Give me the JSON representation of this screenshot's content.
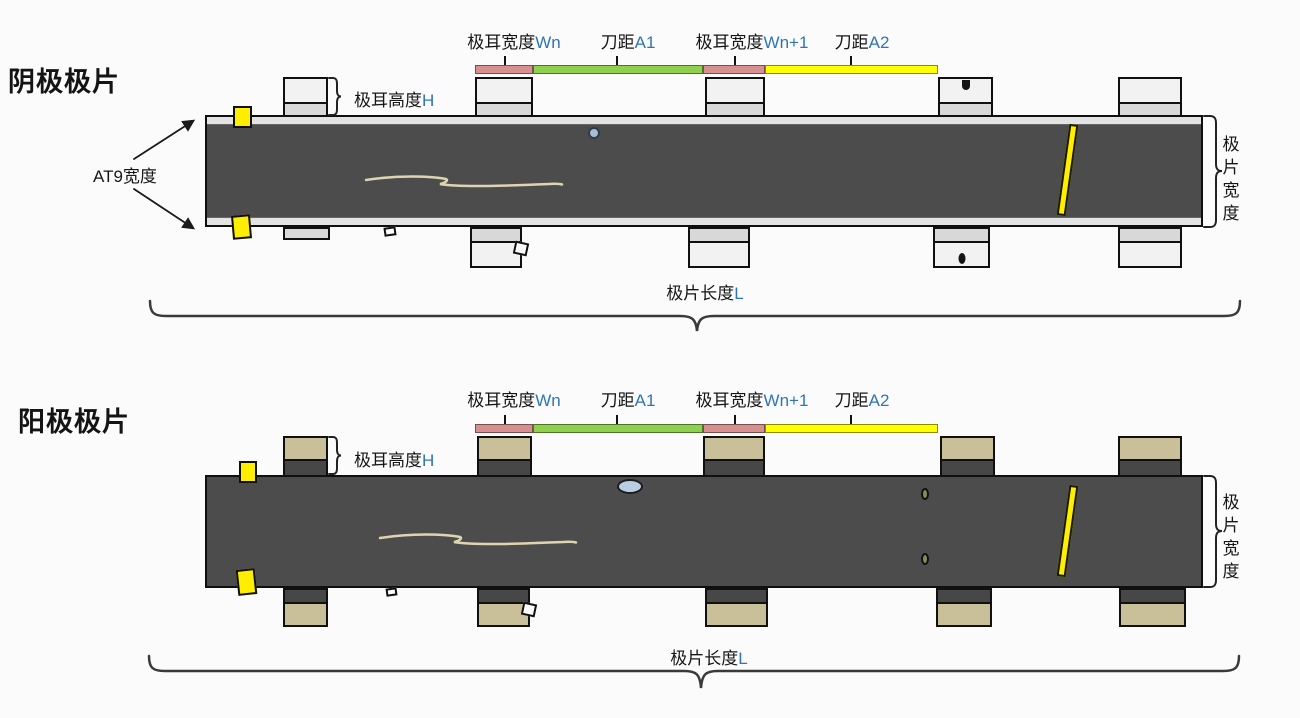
{
  "title_cathode": "阴极极片",
  "title_anode": "阳极极片",
  "dimension_labels": [
    {
      "base": "极耳宽度",
      "accent": "Wn"
    },
    {
      "base": "刀距",
      "accent": "A1"
    },
    {
      "base": "极耳宽度",
      "accent": "Wn+1"
    },
    {
      "base": "刀距",
      "accent": "A2"
    }
  ],
  "tab_height_label": {
    "base": "极耳高度",
    "accent": "H"
  },
  "at9_label": "AT9宽度",
  "sheet_width_label": "极片宽度",
  "sheet_length_label": {
    "base": "极片长度",
    "accent": "L"
  },
  "colors": {
    "accent_text": "#2e75b6",
    "strip_dark": "#4c4c4c",
    "strip_edge_light": "#e3e3e3",
    "cathode_tab_body": "#f2f2f2",
    "cathode_tab_joint": "#d8d8d8",
    "anode_tab_body": "#c9bf99",
    "anode_tab_joint": "#474747",
    "bar_tab_width_pink": "#d79090",
    "bar_knife_a1_green": "#8fd04e",
    "bar_knife_a2_yellow": "#ffff00",
    "edge_marker_yellow": "#ffee00",
    "defect_blue": "#b9cde5",
    "defect_olive": "#8a8a58",
    "defect_dark": "#151515",
    "scribble": "#ddd5b2",
    "outline": "#101010"
  }
}
